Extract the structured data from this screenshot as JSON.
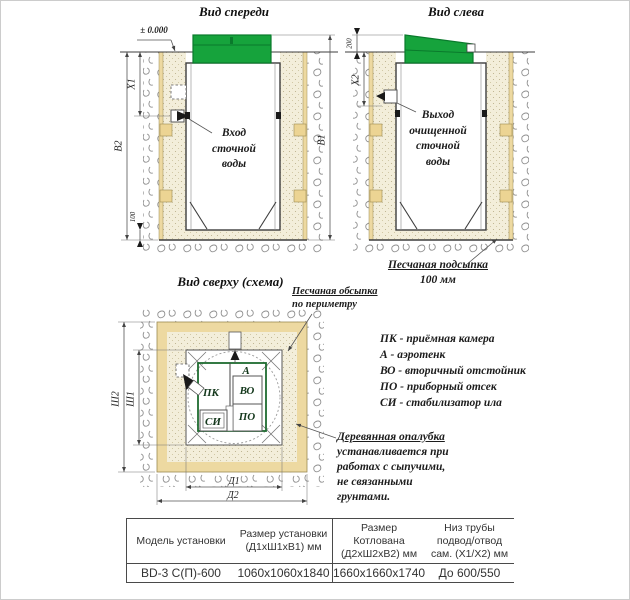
{
  "views": {
    "front": {
      "title": "Вид спереди",
      "datum": "± 0.000",
      "dims": {
        "x1": "X1",
        "b2": "B2",
        "b1": "B1",
        "bedding": "100"
      },
      "inlet_label": [
        "Вход",
        "сточной",
        "воды"
      ]
    },
    "left": {
      "title": "Вид слева",
      "dims": {
        "x2": "X2",
        "lid_height": "200"
      },
      "outlet_label": [
        "Выход",
        "очищенной",
        "сточной",
        "воды"
      ],
      "bedding_note": [
        "Песчаная подсыпка",
        "100 мм"
      ]
    },
    "top": {
      "title": "Вид сверху (схема)",
      "backfill_note": [
        "Песчаная обсыпка",
        "по периметру"
      ],
      "dims": {
        "sh1": "Ш1",
        "sh2": "Ш2",
        "d1": "Д1",
        "d2": "Д2"
      },
      "compartments": {
        "pk": "ПК",
        "a": "А",
        "vo": "ВО",
        "po": "ПО",
        "si": "СИ"
      }
    }
  },
  "legend": [
    "ПК - приёмная камера",
    "А - аэротенк",
    "ВО - вторичный отстойник",
    "ПО - приборный отсек",
    "СИ - стабилизатор ила"
  ],
  "formwork_note": [
    "Деревянная опалубка",
    "устанавливается при",
    "работах с сыпучими,",
    "не связанными",
    "грунтами."
  ],
  "spec_table": {
    "headers": {
      "model": [
        "Модель установки"
      ],
      "unit_size": [
        "Размер установки",
        "(Д1хШ1хВ1) мм"
      ],
      "pit_size": [
        "Размер",
        "Котлована",
        "(Д2хШ2хВ2) мм"
      ],
      "pipe": [
        "Низ трубы",
        "подвод/отвод",
        "сам. (Х1/Х2) мм"
      ]
    },
    "row": [
      "BD-3 С(П)-600",
      "1060x1060x1840",
      "1660x1660x1740",
      "До 600/550"
    ]
  },
  "colors": {
    "lid_green": "#16a33c",
    "lid_green_dark": "#0a7a2c",
    "formwork_tan": "#edd9a1",
    "sand": "#f3eeda",
    "green_frame": "#1e6b30"
  }
}
